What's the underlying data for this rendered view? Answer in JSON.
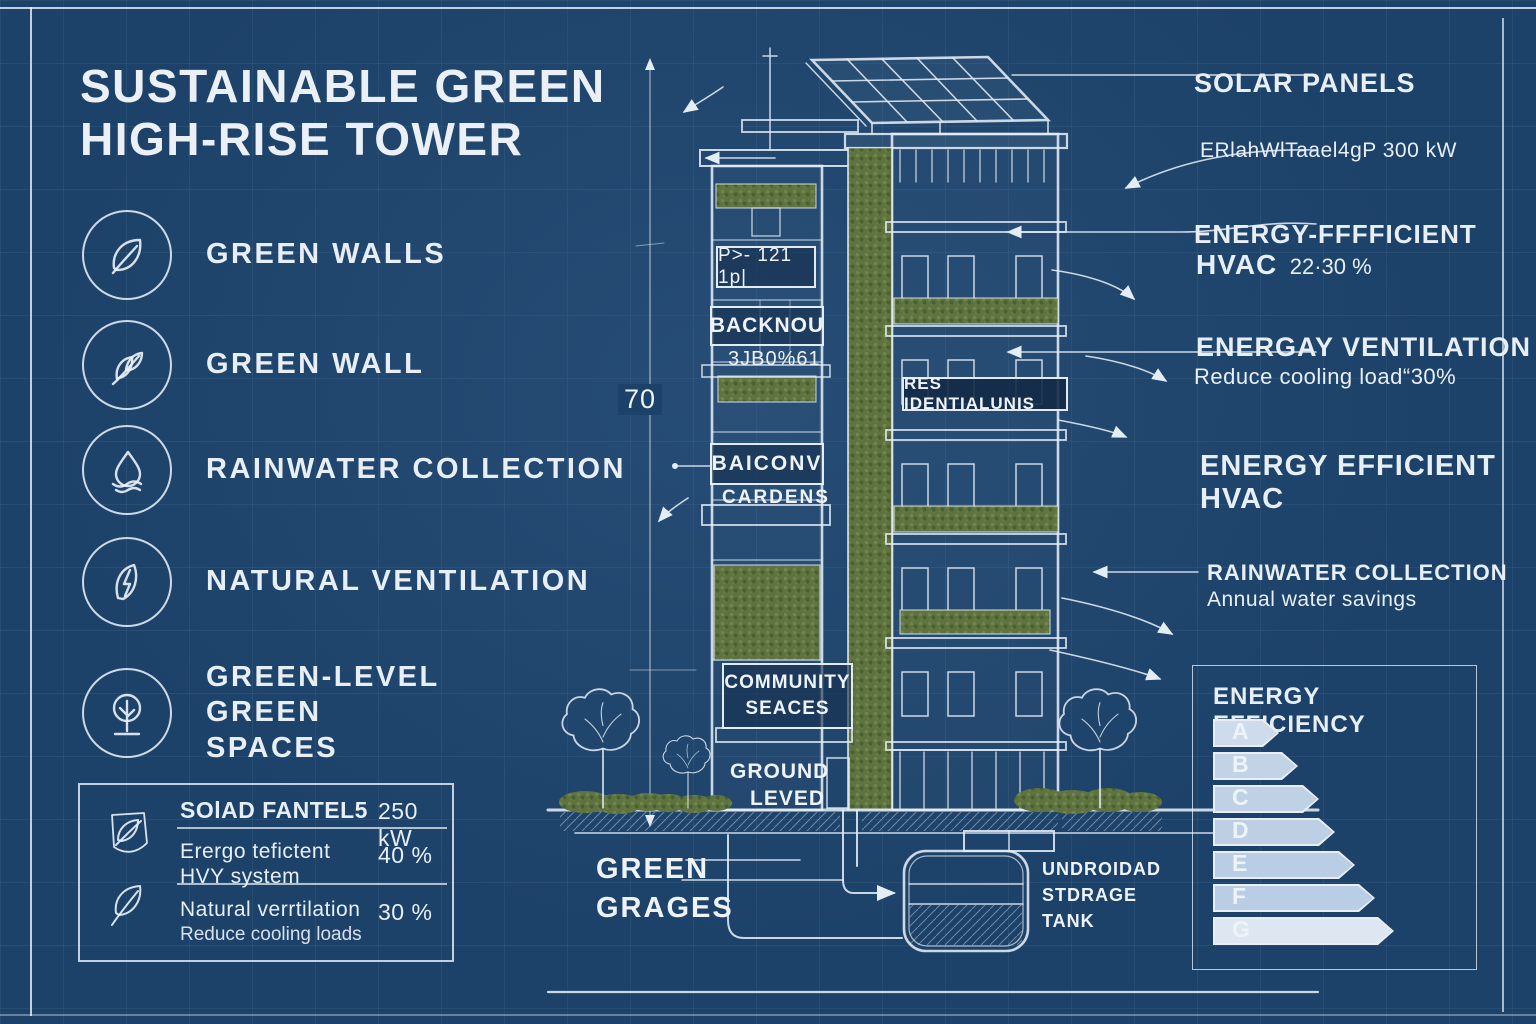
{
  "title": "SUSTAINABLE GREEN HIGH-RISE TOWER",
  "features": [
    {
      "icon": "leaf-icon",
      "label": "GREEN WALLS"
    },
    {
      "icon": "sprout-icon",
      "label": "GREEN WALL"
    },
    {
      "icon": "water-drop-icon",
      "label": "RAINWATER COLLECTION"
    },
    {
      "icon": "leaf-bolt-icon",
      "label": "NATURAL VENTILATION"
    },
    {
      "icon": "tree-icon",
      "label": "GREEN-LEVEL GREEN SPACES"
    }
  ],
  "stats": {
    "rows": [
      {
        "label": "SOlAD FANTEL5",
        "value": "250 kW"
      },
      {
        "label": "Erergo tefictent HVY system",
        "value": "40 %"
      },
      {
        "label": "Natural verrtilation",
        "sub": "Reduce cooling loads",
        "value": "30 %"
      }
    ]
  },
  "building": {
    "dimension": "70",
    "panel_tag": "P>- 121 1p|",
    "level_label": "BACKNOU",
    "level_sub": "3JB0%61",
    "balcony_label": "BAICONV",
    "balcony_sub": "CARDENS",
    "residential_label": "RES IDENTIALUNIS",
    "community_line1": "COMMUNITY",
    "community_line2": "SEACES",
    "ground_line1": "GROUND",
    "ground_line2": "LEVED",
    "garages_line1": "GREEN",
    "garages_line2": "GRAGES",
    "tank_line1": "UNDROIDAD",
    "tank_line2": "STDRAGE",
    "tank_line3": "TANK"
  },
  "annotations": {
    "solar_title": "SOLAR PANELS",
    "solar_value": "ERlahWlTaael4gP 300 kW",
    "hvac1_title": "ENERGY-FFFFICIENT",
    "hvac1_sub": "HVAC",
    "hvac1_value": "22·30 %",
    "vent_title": "ENERGAY VENTILATION",
    "vent_sub": "Reduce cooling load“30%",
    "hvac2_title": "ENERGY EFFICIENT",
    "hvac2_sub": "HVAC",
    "rain_title": "RAINWATER COLLECTION",
    "rain_sub": "Annual water savings"
  },
  "energy_scale": {
    "title": "ENERGY EFFICIENCY",
    "bars": [
      {
        "letter": "A",
        "width": 66,
        "fill": "rgba(142,174,209,0.30)"
      },
      {
        "letter": "B",
        "width": 85,
        "fill": "rgba(142,174,209,0.42)"
      },
      {
        "letter": "C",
        "width": 106,
        "fill": "rgba(142,174,209,0.46)"
      },
      {
        "letter": "D",
        "width": 122,
        "fill": "rgba(152,182,215,0.55)"
      },
      {
        "letter": "E",
        "width": 142,
        "fill": "rgba(152,182,215,0.58)"
      },
      {
        "letter": "F",
        "width": 162,
        "fill": "rgba(157,186,218,0.62)"
      },
      {
        "letter": "G",
        "width": 181,
        "fill": "rgba(142,174,209,0.10)"
      }
    ]
  },
  "colors": {
    "background": "#1d4269",
    "ink": "#e7eef5",
    "foliage": "#5f7340"
  }
}
